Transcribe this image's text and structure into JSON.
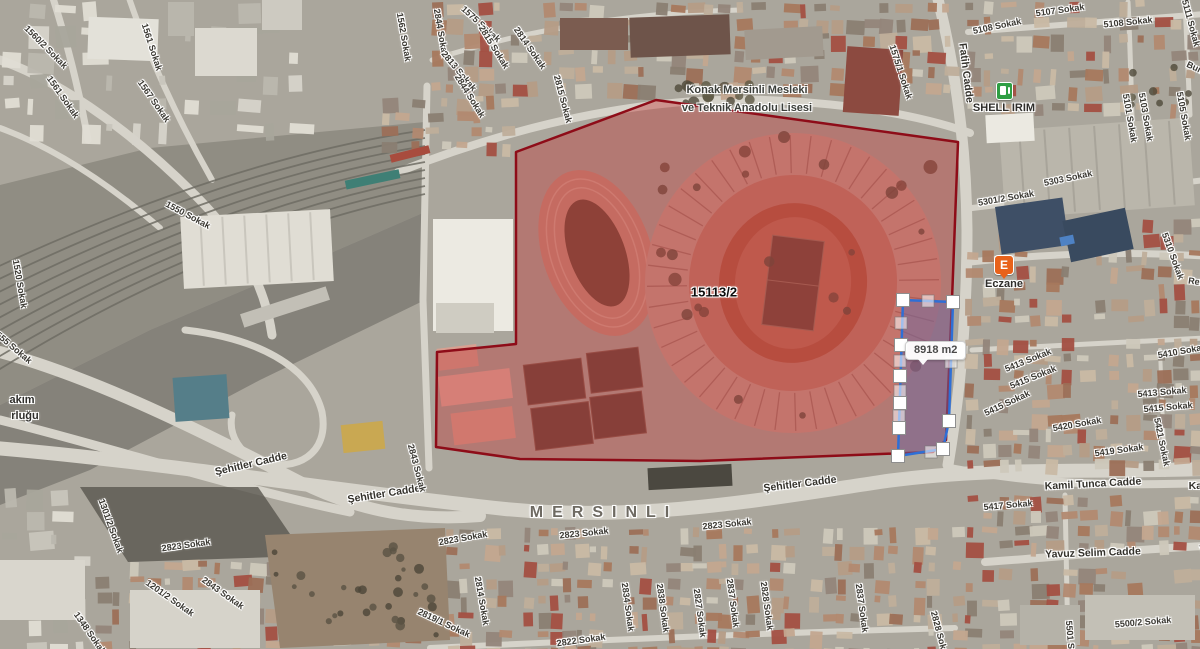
{
  "map": {
    "district_label": "MERSINLI",
    "parcel": {
      "number": "15113/2",
      "area": "8918 m2"
    },
    "school": {
      "line1": "Konak Mersinli Mesleki",
      "line2": "ve Teknik Anadolu Lisesi"
    },
    "poi": {
      "fuel_station": "SHELL IRIM",
      "pharmacy_label": "Eczane",
      "pharmacy_symbol": "E"
    },
    "colors": {
      "block_fill": "#c23b3b",
      "block_border": "#8e0c18",
      "parcel_fill": "#6f6aa0",
      "parcel_border": "#2e6fd6",
      "handle_fill": "#ffffff",
      "handle_border": "#8e8e8e"
    },
    "overlay": {
      "red_block_points": [
        [
          516,
          152
        ],
        [
          656,
          100
        ],
        [
          958,
          142
        ],
        [
          952,
          300
        ],
        [
          946,
          440
        ],
        [
          933,
          452
        ],
        [
          700,
          461
        ],
        [
          520,
          459
        ],
        [
          436,
          447
        ],
        [
          437,
          352
        ],
        [
          516,
          344
        ]
      ],
      "selected_parcel_points": [
        [
          903,
          300
        ],
        [
          953,
          302
        ],
        [
          949,
          421
        ],
        [
          943,
          449
        ],
        [
          898,
          456
        ]
      ],
      "vertex_handles": [
        [
          903,
          300
        ],
        [
          953,
          302
        ],
        [
          949,
          421
        ],
        [
          943,
          449
        ],
        [
          898,
          456
        ],
        [
          901,
          345
        ],
        [
          900,
          376
        ],
        [
          900,
          403
        ],
        [
          899,
          428
        ]
      ],
      "midpoint_handles": [
        [
          928,
          301
        ],
        [
          951,
          362
        ],
        [
          931,
          452
        ],
        [
          901,
          323
        ],
        [
          900,
          361
        ],
        [
          900,
          391
        ],
        [
          899,
          416
        ]
      ],
      "tooltip_text": "8918 m2"
    },
    "street_labels": [
      {
        "text": "1560/2 Sokak",
        "x": 46,
        "y": 47,
        "rot": 45,
        "cls": "street"
      },
      {
        "text": "1561 Sokak",
        "x": 152,
        "y": 47,
        "rot": 72,
        "cls": "street"
      },
      {
        "text": "1561 Sokak",
        "x": 63,
        "y": 97,
        "rot": 55,
        "cls": "street"
      },
      {
        "text": "1567 Sokak",
        "x": 154,
        "y": 101,
        "rot": 55,
        "cls": "street"
      },
      {
        "text": "1550 Sokak",
        "x": 188,
        "y": 215,
        "rot": 28,
        "cls": "street"
      },
      {
        "text": "1520 Sokak",
        "x": 20,
        "y": 284,
        "rot": 80,
        "cls": "street"
      },
      {
        "text": "1555 Sokak",
        "x": 12,
        "y": 346,
        "rot": 40,
        "cls": "street"
      },
      {
        "text": "akım",
        "x": 22,
        "y": 400,
        "rot": 0,
        "cls": "poi"
      },
      {
        "text": "rluğu",
        "x": 25,
        "y": 416,
        "rot": 0,
        "cls": "poi"
      },
      {
        "text": "1562 Sokak",
        "x": 404,
        "y": 37,
        "rot": 80,
        "cls": "street"
      },
      {
        "text": "2844 Sokak",
        "x": 441,
        "y": 33,
        "rot": 80,
        "cls": "street"
      },
      {
        "text": "1575 Sokak",
        "x": 481,
        "y": 24,
        "rot": 42,
        "cls": "street"
      },
      {
        "text": "2815 Sokak",
        "x": 494,
        "y": 47,
        "rot": 58,
        "cls": "street"
      },
      {
        "text": "2813 Sokak",
        "x": 459,
        "y": 71,
        "rot": 50,
        "cls": "street"
      },
      {
        "text": "2844 Sokak",
        "x": 470,
        "y": 96,
        "rot": 58,
        "cls": "street"
      },
      {
        "text": "2814 Sokak",
        "x": 530,
        "y": 48,
        "rot": 55,
        "cls": "street"
      },
      {
        "text": "2815 Sokak",
        "x": 563,
        "y": 99,
        "rot": 75,
        "cls": "street"
      },
      {
        "text": "1575/1 Sokak",
        "x": 901,
        "y": 72,
        "rot": 72,
        "cls": "street"
      },
      {
        "text": "5107 Sokak",
        "x": 1060,
        "y": 10,
        "rot": -8,
        "cls": "street"
      },
      {
        "text": "5108 Sokak",
        "x": 997,
        "y": 26,
        "rot": -12,
        "cls": "street"
      },
      {
        "text": "5108 Sokak",
        "x": 1128,
        "y": 22,
        "rot": -6,
        "cls": "street"
      },
      {
        "text": "5111 Sokak",
        "x": 1191,
        "y": 23,
        "rot": 75,
        "cls": "street"
      },
      {
        "text": "Fatih Cadde",
        "x": 966,
        "y": 73,
        "rot": 83,
        "cls": "avenue"
      },
      {
        "text": "Burak Reis Cadde",
        "x": 1222,
        "y": 80,
        "rot": 25,
        "cls": "street"
      },
      {
        "text": "5101 Sokak",
        "x": 1130,
        "y": 118,
        "rot": 80,
        "cls": "street"
      },
      {
        "text": "5103 Sokak",
        "x": 1146,
        "y": 117,
        "rot": 80,
        "cls": "street"
      },
      {
        "text": "5105 Sokak",
        "x": 1184,
        "y": 116,
        "rot": 80,
        "cls": "street"
      },
      {
        "text": "5303 Sokak",
        "x": 1068,
        "y": 178,
        "rot": -12,
        "cls": "street"
      },
      {
        "text": "5301/2 Sokak",
        "x": 1006,
        "y": 198,
        "rot": -10,
        "cls": "street"
      },
      {
        "text": "5310 Sokak",
        "x": 1173,
        "y": 256,
        "rot": 70,
        "cls": "street"
      },
      {
        "text": "Refik Cadde",
        "x": 1214,
        "y": 284,
        "rot": 8,
        "cls": "street"
      },
      {
        "text": "5410 Sokak",
        "x": 1182,
        "y": 351,
        "rot": -10,
        "cls": "street"
      },
      {
        "text": "5413 Sokak",
        "x": 1028,
        "y": 360,
        "rot": -22,
        "cls": "street"
      },
      {
        "text": "5415 Sokak",
        "x": 1033,
        "y": 377,
        "rot": -22,
        "cls": "street"
      },
      {
        "text": "5413 Sokak",
        "x": 1162,
        "y": 392,
        "rot": -5,
        "cls": "street"
      },
      {
        "text": "5415 Sokak",
        "x": 1168,
        "y": 407,
        "rot": -5,
        "cls": "street"
      },
      {
        "text": "5415 Sokak",
        "x": 1007,
        "y": 403,
        "rot": -25,
        "cls": "street"
      },
      {
        "text": "5420 Sokak",
        "x": 1077,
        "y": 424,
        "rot": -10,
        "cls": "street"
      },
      {
        "text": "5419 Sokak",
        "x": 1119,
        "y": 450,
        "rot": -8,
        "cls": "street"
      },
      {
        "text": "5421 Sokak",
        "x": 1162,
        "y": 442,
        "rot": 78,
        "cls": "street"
      },
      {
        "text": "Kamil Tunca Cadde",
        "x": 1093,
        "y": 484,
        "rot": -3,
        "cls": "avenue"
      },
      {
        "text": "Kamil Tunca Cadde",
        "x": 1237,
        "y": 486,
        "rot": 0,
        "cls": "avenue"
      },
      {
        "text": "5417 Sokak",
        "x": 1008,
        "y": 505,
        "rot": -5,
        "cls": "street"
      },
      {
        "text": "Yavuz Selim Cadde",
        "x": 1093,
        "y": 553,
        "rot": -2,
        "cls": "avenue"
      },
      {
        "text": "Yavuz Selim Cadde",
        "x": 1247,
        "y": 548,
        "rot": -2,
        "cls": "avenue"
      },
      {
        "text": "5500/2 Sokak",
        "x": 1143,
        "y": 622,
        "rot": -5,
        "cls": "street"
      },
      {
        "text": "5501 Sokak",
        "x": 1071,
        "y": 645,
        "rot": 85,
        "cls": "street"
      },
      {
        "text": "Şehitler Cadde",
        "x": 251,
        "y": 464,
        "rot": -13,
        "cls": "avenue"
      },
      {
        "text": "Şehitler Cadde",
        "x": 384,
        "y": 494,
        "rot": -9,
        "cls": "avenue"
      },
      {
        "text": "Şehitler Cadde",
        "x": 800,
        "y": 484,
        "rot": -7,
        "cls": "avenue"
      },
      {
        "text": "2843 Sokak",
        "x": 417,
        "y": 468,
        "rot": 75,
        "cls": "street"
      },
      {
        "text": "2823 Sokak",
        "x": 463,
        "y": 538,
        "rot": -10,
        "cls": "street"
      },
      {
        "text": "2823 Sokak",
        "x": 584,
        "y": 533,
        "rot": -6,
        "cls": "street"
      },
      {
        "text": "2823 Sokak",
        "x": 727,
        "y": 524,
        "rot": -6,
        "cls": "street"
      },
      {
        "text": "2823 Sokak",
        "x": 186,
        "y": 545,
        "rot": -8,
        "cls": "street"
      },
      {
        "text": "1301/2 Sokak",
        "x": 111,
        "y": 526,
        "rot": 70,
        "cls": "street"
      },
      {
        "text": "1201/2 Sokak",
        "x": 170,
        "y": 598,
        "rot": 35,
        "cls": "street"
      },
      {
        "text": "2843 Sokak",
        "x": 223,
        "y": 593,
        "rot": 35,
        "cls": "street"
      },
      {
        "text": "1348 Sokak",
        "x": 90,
        "y": 633,
        "rot": 55,
        "cls": "street"
      },
      {
        "text": "2814 Sokak",
        "x": 482,
        "y": 601,
        "rot": 80,
        "cls": "street"
      },
      {
        "text": "2819/1 Sokak",
        "x": 444,
        "y": 623,
        "rot": 25,
        "cls": "street"
      },
      {
        "text": "2822 Sokak",
        "x": 581,
        "y": 640,
        "rot": -8,
        "cls": "street"
      },
      {
        "text": "2834 Sokak",
        "x": 628,
        "y": 607,
        "rot": 82,
        "cls": "street"
      },
      {
        "text": "2838 Sokak",
        "x": 663,
        "y": 608,
        "rot": 82,
        "cls": "street"
      },
      {
        "text": "2827 Sokak",
        "x": 700,
        "y": 613,
        "rot": 82,
        "cls": "street"
      },
      {
        "text": "2837 Sokak",
        "x": 733,
        "y": 603,
        "rot": 82,
        "cls": "street"
      },
      {
        "text": "2828 Sokak",
        "x": 767,
        "y": 606,
        "rot": 82,
        "cls": "street"
      },
      {
        "text": "2837 Sokak",
        "x": 862,
        "y": 608,
        "rot": 82,
        "cls": "street"
      },
      {
        "text": "2828 Sokak",
        "x": 940,
        "y": 635,
        "rot": 75,
        "cls": "street"
      }
    ]
  }
}
